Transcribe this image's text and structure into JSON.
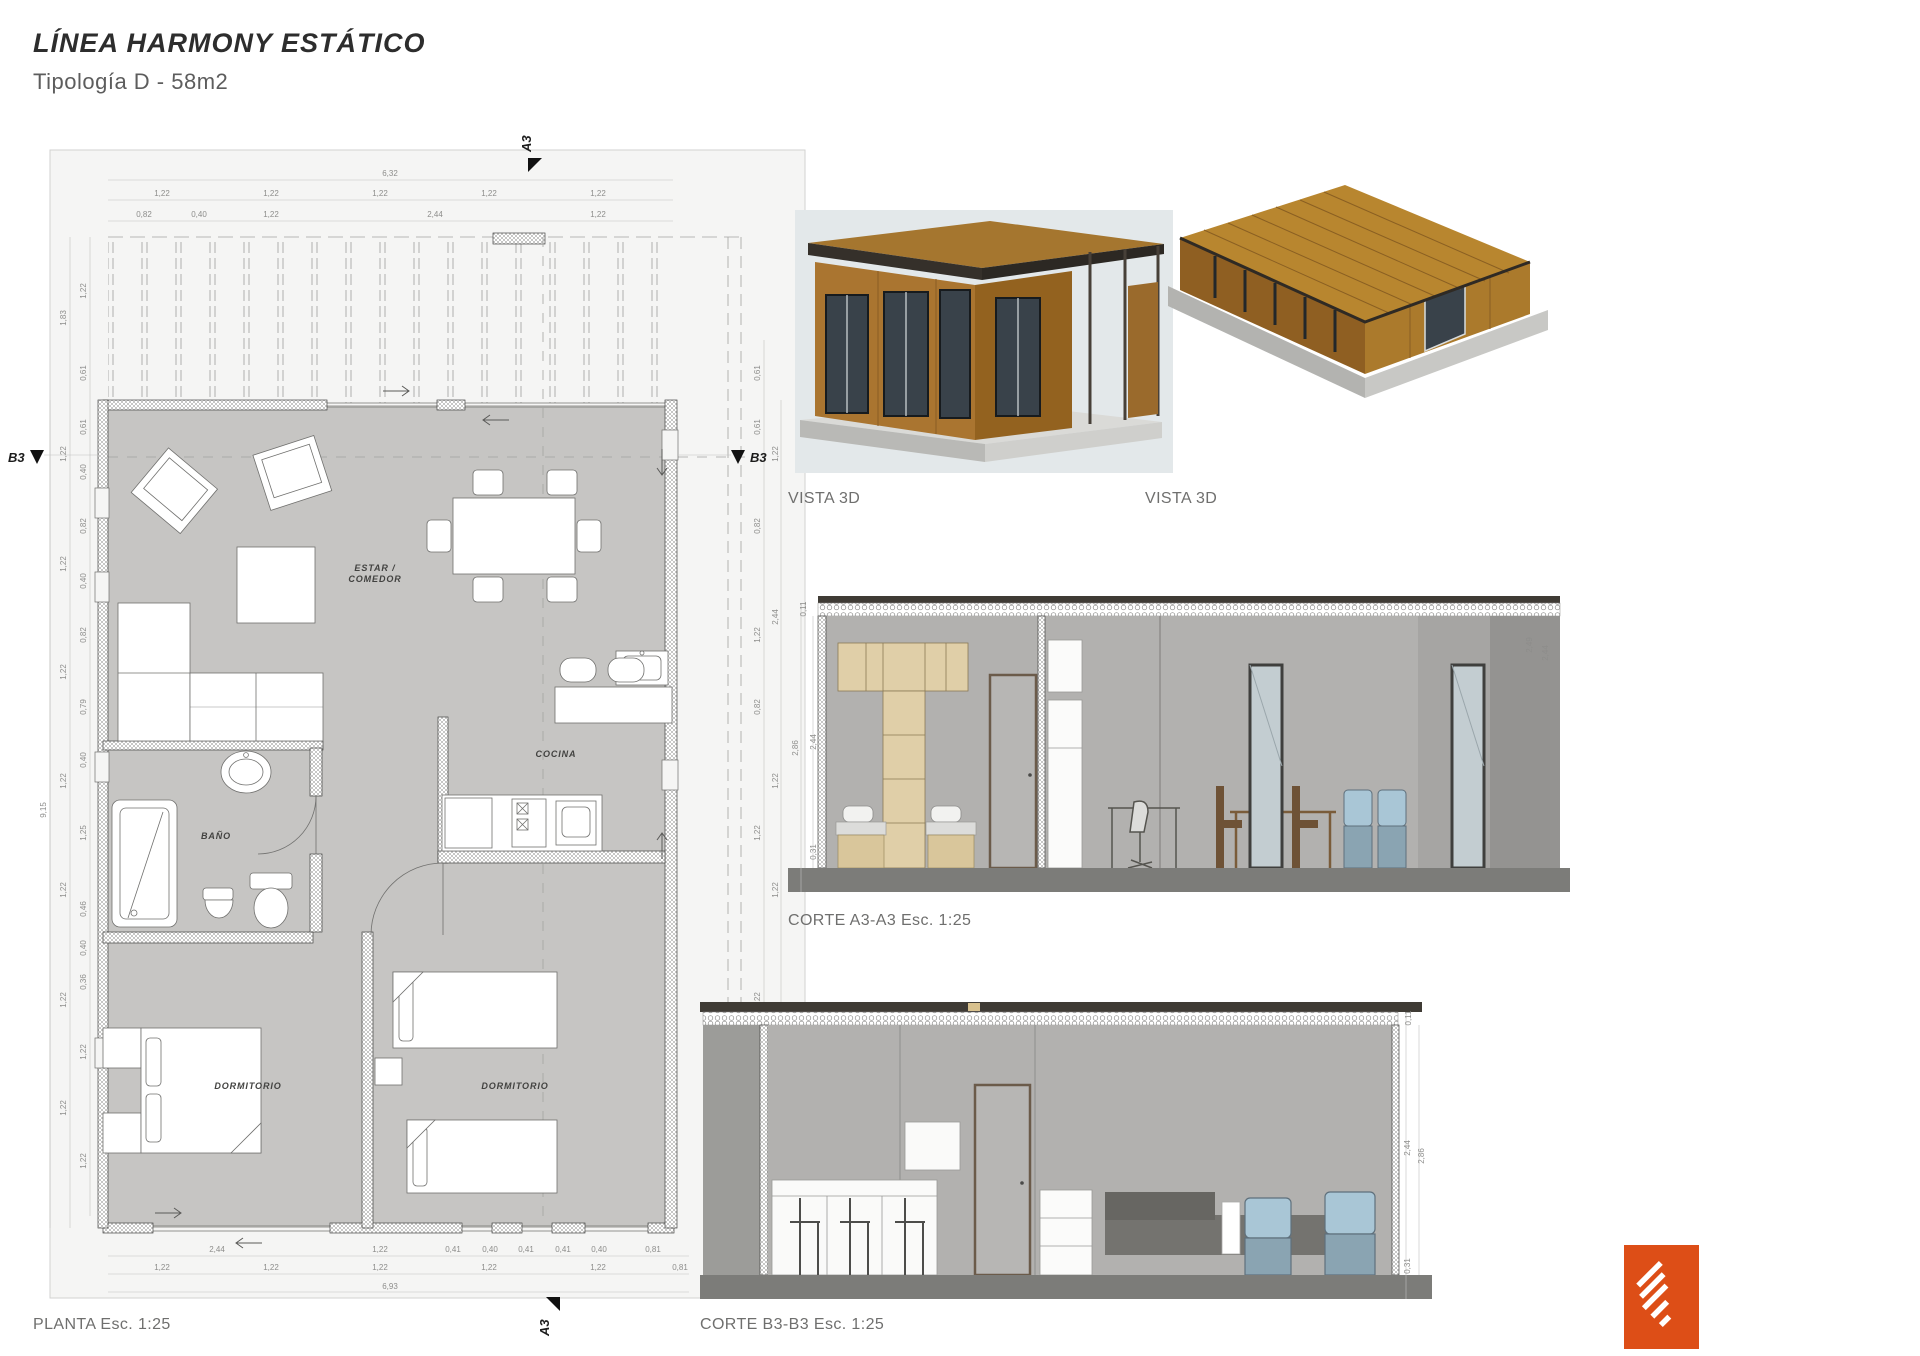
{
  "header": {
    "title": "LÍNEA HARMONY ESTÁTICO",
    "subtitle": "Tipología D - 58m2"
  },
  "plan": {
    "label": "PLANTA Esc. 1:25",
    "rooms": {
      "living1": "ESTAR /",
      "living2": "COMEDOR",
      "kitchen": "COCINA",
      "bath": "BAÑO",
      "bed1": "DORMITORIO",
      "bed2": "DORMITORIO"
    },
    "markers": {
      "a3": "A3",
      "b3": "B3"
    },
    "dims": {
      "top_total": "6,32",
      "top_row1": [
        "1,22",
        "1,22",
        "1,22",
        "1,22",
        "1,22"
      ],
      "top_row2": [
        "0,82",
        "0,40",
        "1,22",
        "2,44",
        "1,22"
      ],
      "bottom_row1": [
        "2,44",
        "1,22",
        "0,41",
        "0,40",
        "0,41",
        "0,41",
        "0,40",
        "0,81"
      ],
      "bottom_row2": [
        "1,22",
        "1,22",
        "1,22",
        "1,22",
        "1,22",
        "0,81"
      ],
      "bottom_total": "6,93",
      "left_total": "9,15",
      "left_mid": [
        "1,83",
        "1,22",
        "1,22",
        "1,22",
        "1,22",
        "1,22",
        "1,22",
        "1,22"
      ],
      "left_inner": [
        "1,22",
        "0,61",
        "0,61",
        "0,40",
        "0,82",
        "0,40",
        "0,82",
        "0,79",
        "0,40",
        "1,25",
        "0,46",
        "0,40",
        "0,36",
        "1,22",
        "1,22"
      ],
      "right_inner": [
        "0,61",
        "0,61",
        "0,82",
        "1,22",
        "0,82",
        "1,22",
        "1,22",
        "0,81"
      ],
      "right_outer": [
        "1,22",
        "2,44",
        "1,22",
        "1,22",
        "2,44",
        "1,22"
      ]
    }
  },
  "views": {
    "vista1_label": "VISTA 3D",
    "vista2_label": "VISTA 3D"
  },
  "sections": {
    "a3": {
      "label": "CORTE A3-A3 Esc. 1:25",
      "dim_roof": "0,11",
      "dim_clear": "2,44",
      "dim_total": "2,86",
      "dim_plinth": "0,31",
      "dim_terrace1": "2,49",
      "dim_terrace2": "2,44"
    },
    "b3": {
      "label": "CORTE B3-B3 Esc. 1:25",
      "dim_roof": "0,11",
      "dim_clear": "2,44",
      "dim_total": "2,86",
      "dim_plinth": "0,31"
    }
  },
  "colors": {
    "accent_orange": "#dd4e17",
    "plan_room_fill": "#c6c5c3",
    "section_wall_fill": "#b2b1af",
    "wood_brown": "#ad7730",
    "roof_tan": "#b8862f",
    "cushion_blue": "#a9c6d6",
    "backdrop_blue_gray": "#e3e8ea"
  }
}
